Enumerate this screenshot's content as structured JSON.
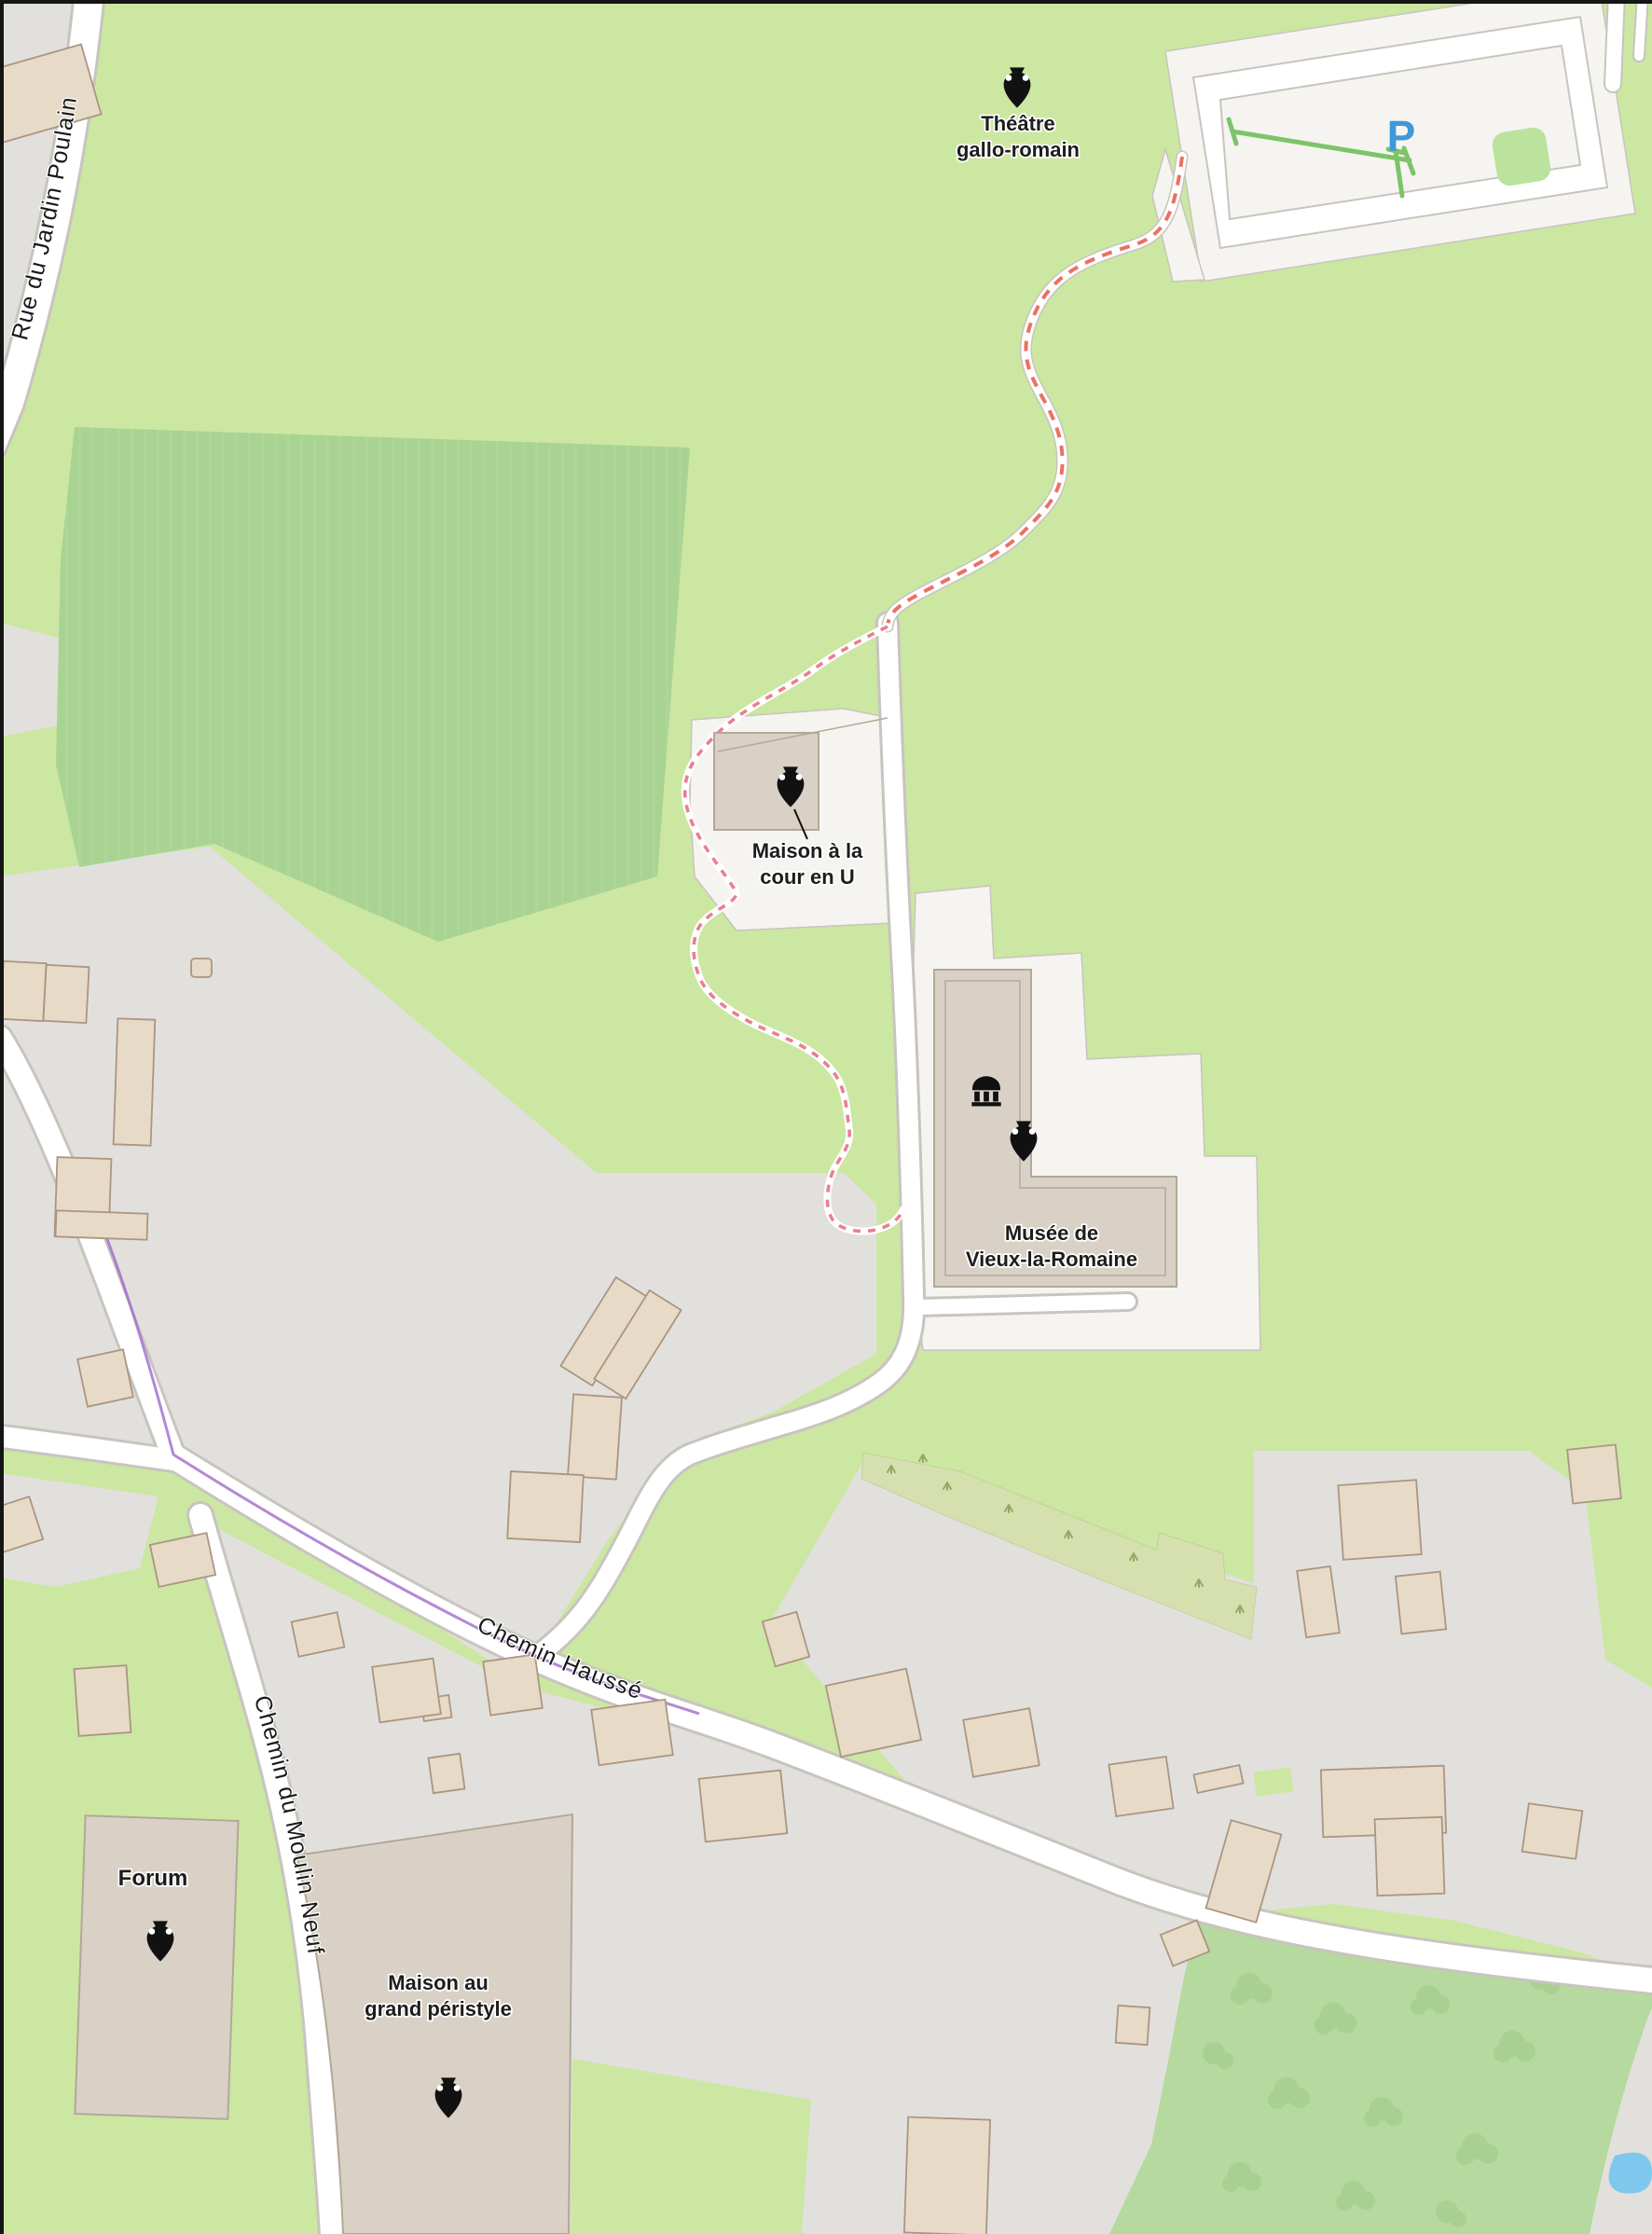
{
  "map": {
    "description": "OpenStreetMap-style map of the Vieux-la-Romaine gallo-roman archaeological area",
    "pois": {
      "theatre": {
        "line1": "Théâtre",
        "line2": "gallo-romain",
        "icon": "amphora-icon"
      },
      "maison_cour_u": {
        "line1": "Maison à la",
        "line2": "cour en U",
        "icon": "amphora-icon"
      },
      "musee": {
        "line1": "Musée de",
        "line2": "Vieux-la-Romaine",
        "icons": "museum-icon, amphora-icon"
      },
      "forum": {
        "label": "Forum",
        "icon": "amphora-icon"
      },
      "maison_grand_peristyle": {
        "line1": "Maison au",
        "line2": "grand péristyle",
        "icon": "amphora-icon"
      }
    },
    "roads": {
      "rue_jardin_poulain": {
        "name": "Rue du Jardin Poulain"
      },
      "chemin_hausse": {
        "name": "Chemin Haussé"
      },
      "chemin_moulin_neuf": {
        "name": "Chemin du Moulin Neuf"
      }
    },
    "parking": {
      "symbol": "P"
    },
    "features": [
      "parking-lot",
      "footpath-dashed",
      "orchards",
      "farm-buildings",
      "pond"
    ],
    "colors": {
      "grass": "#cbe7a2",
      "field": "#a9d392",
      "residential": "#e2e0dd",
      "compound_white": "#f6f4f0",
      "site_fill": "#dad1c6",
      "site_stroke": "#b4a797",
      "building_fill": "#e7dac6",
      "building_stroke": "#aa9682",
      "road_fill": "#ffffff",
      "road_casing": "#c8c4be",
      "path_dash": "#ec7160",
      "footpath_dash": "#ea7f92",
      "boundary": "#a06ccc",
      "orchard": "#d6dfae",
      "orchard_tree": "#97a863",
      "meadow_tree": "#a6cf8e",
      "orchard2": "#b5d99f",
      "water": "#7ec8ee",
      "hedge": "#7cc46a",
      "tree_square": "#bbe39e",
      "parking_blue": "#3d99d9",
      "label": "#1d1d1d",
      "border": "#151515"
    }
  }
}
